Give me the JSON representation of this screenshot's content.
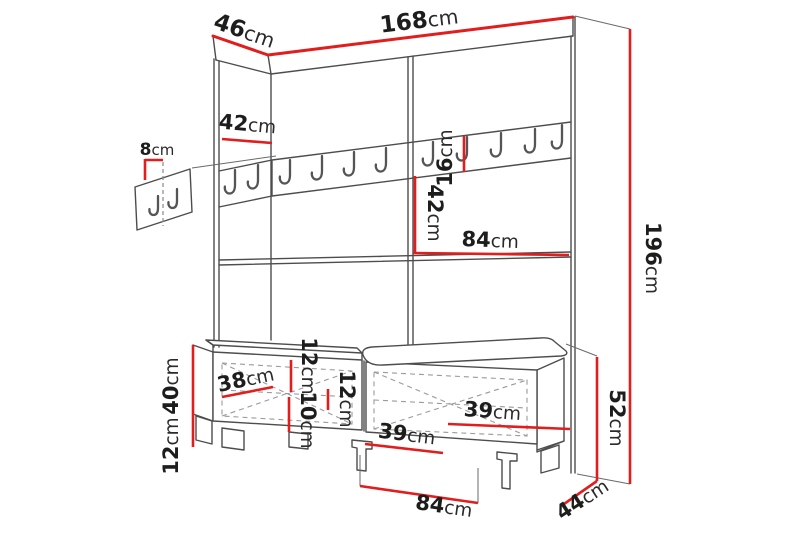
{
  "diagram": {
    "type": "furniture-dimension-drawing",
    "product": "hallway wardrobe with coat hooks and shoe bench",
    "unit_system": "cm",
    "colors": {
      "dimension_line": "#e11d1d",
      "outline": "#4d4d4d",
      "dashed_detail": "#9a9a9a",
      "label_text": "#1d1d1b",
      "background": "#ffffff"
    },
    "icons": {
      "coat_hook": "j-shaped-hook"
    },
    "dims": {
      "wardrobe_width": {
        "value": "168",
        "unit": "cm"
      },
      "wardrobe_depth": {
        "value": "46",
        "unit": "cm"
      },
      "left_section_width": {
        "value": "42",
        "unit": "cm"
      },
      "hook_spacing": {
        "value": "8",
        "unit": "cm"
      },
      "hook_rail_height": {
        "value": "16",
        "unit": "cm"
      },
      "middle_section_height": {
        "value": "42",
        "unit": "cm"
      },
      "right_section_width": {
        "value": "84",
        "unit": "cm"
      },
      "total_height": {
        "value": "196",
        "unit": "cm"
      },
      "bench_body_height": {
        "value": "40",
        "unit": "cm"
      },
      "bench_leg_height": {
        "value": "12",
        "unit": "cm"
      },
      "bench_inner_width": {
        "value": "38",
        "unit": "cm"
      },
      "seat_cushion_height": {
        "value": "12",
        "unit": "cm"
      },
      "seat_gap_height": {
        "value": "10",
        "unit": "cm"
      },
      "right_seat_cushion_height": {
        "value": "12",
        "unit": "cm"
      },
      "left_door_width": {
        "value": "39",
        "unit": "cm"
      },
      "right_door_width": {
        "value": "39",
        "unit": "cm"
      },
      "bench_total_height": {
        "value": "52",
        "unit": "cm"
      },
      "bench_width": {
        "value": "84",
        "unit": "cm"
      },
      "bench_depth": {
        "value": "44",
        "unit": "cm"
      }
    }
  }
}
